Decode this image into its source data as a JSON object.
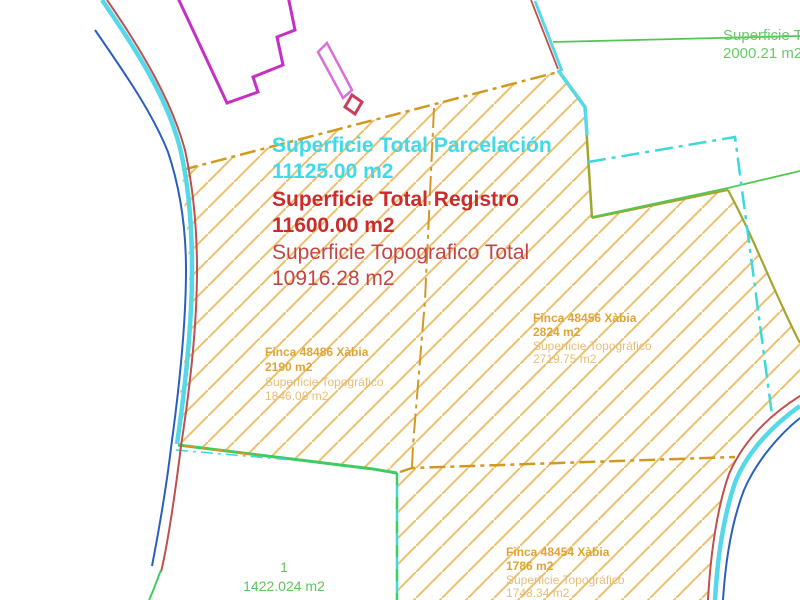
{
  "totals": {
    "parcelacion_label": "Superficie Total Parcelación",
    "parcelacion_value": "11125.00 m2",
    "registro_label": "Superficie Total Registro",
    "registro_value": "11600.00 m2",
    "topografico_label": "Superficie Topografico Total",
    "topografico_value": "10916.28 m2"
  },
  "neighbor_parcel": {
    "label": "Superficie Tot",
    "value": "2000.21 m2"
  },
  "fincas": [
    {
      "name": "Finca 48486 Xàbia",
      "area_registral": "2190 m2",
      "topo_label": "Superficie Topográfico",
      "topo_area": "1846.08 m2"
    },
    {
      "name": "Finca 48456 Xàbia",
      "area_registral": "2824 m2",
      "topo_label": "Superficie Topográfico",
      "topo_area": "2719.75 m2"
    },
    {
      "name": "Finca 48454 Xàbia",
      "area_registral": "1786 m2",
      "topo_label": "Superficie Topográfico",
      "topo_area": "1748.34 m2"
    }
  ],
  "plot_1": {
    "number": "1",
    "area": "1422.024 m2"
  },
  "colors": {
    "hatch_orange": "#EAC06C",
    "parcel_boundary_orange": "#D0991F",
    "road_cyan": "#55D8E8",
    "road_red": "#C0504D",
    "road_blue": "#2B5FBF",
    "boundary_green": "#3FCB5F",
    "neighbor_green": "#53C653",
    "olive_boundary": "#A3A52E",
    "cyan_dashdot": "#3DD9D9",
    "building_magenta": "#C52FC5",
    "building_pink": "#D96FD9",
    "building_red": "#C94158",
    "title_cyan": "#3FD9E8",
    "title_red": "#CC2B2B",
    "finca_label_orange": "#DFA437",
    "text_green": "#66CB66"
  }
}
